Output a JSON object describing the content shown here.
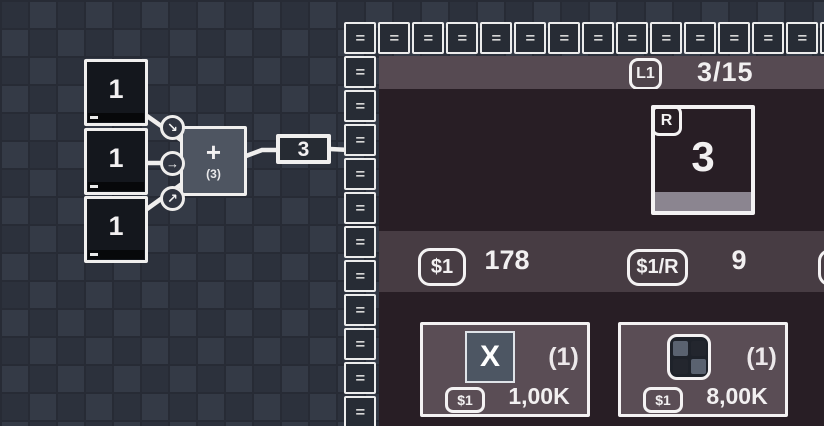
{
  "colors": {
    "bg_base": "#2f3440",
    "bg_tile_light": "#343a46",
    "bg_tile_dark": "#2c313c",
    "grid_line": "#272b35",
    "belt_tile": "#272c35",
    "panel_dark": "#281e25",
    "panel_header": "#564a52",
    "panel_stats": "#473c43",
    "card_fill": "#5a4d55",
    "node_fill": "#4e5561",
    "source_fill": "#14171d",
    "muted_strip": "#8b8590",
    "x_icon_fill": "#4d5663",
    "grid_icon_light": "#5a6270",
    "grid_icon_dark": "#23262e"
  },
  "graph": {
    "sources": [
      {
        "value": "1"
      },
      {
        "value": "1"
      },
      {
        "value": "1"
      }
    ],
    "adder": {
      "operator": "+",
      "buffer": "(3)"
    },
    "output": {
      "value": "3"
    },
    "connector_arrows": [
      "↘",
      "→",
      "↗"
    ]
  },
  "conveyor": {
    "glyph": "=",
    "top_count": 15,
    "left_count": 11
  },
  "panel": {
    "header": {
      "level_badge": "L1",
      "progress": "3/15"
    },
    "resource_card": {
      "badge": "R",
      "value": "3"
    },
    "stats": [
      {
        "badge": "$1",
        "value": "178"
      },
      {
        "badge": "$1/R",
        "value": "9"
      }
    ],
    "shop": [
      {
        "icon_label": "X",
        "count": "(1)",
        "price_badge": "$1",
        "price": "1,00K"
      },
      {
        "count": "(1)",
        "price_badge": "$1",
        "price": "8,00K"
      }
    ]
  }
}
